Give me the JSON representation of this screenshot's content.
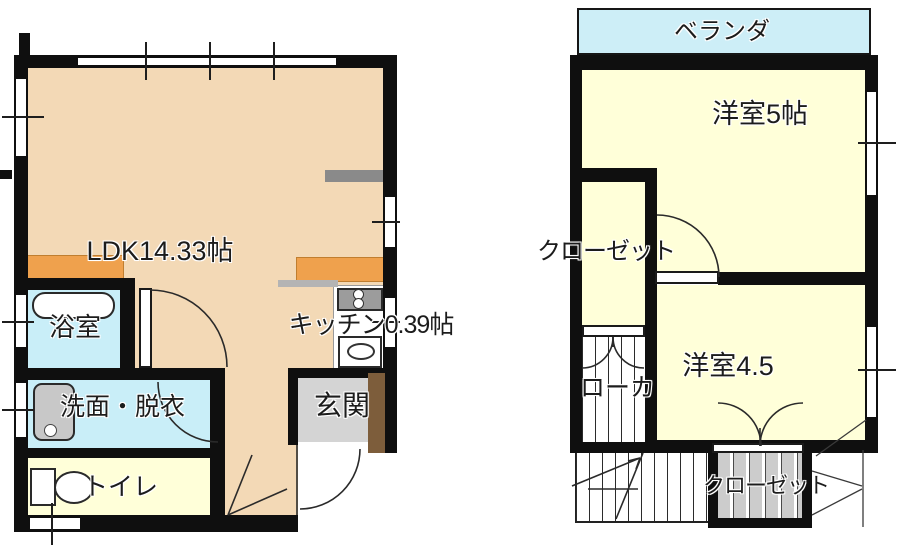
{
  "floor1": {
    "ldk": "LDK14.33帖",
    "bath": "浴室",
    "washroom": "洗面・脱衣",
    "toilet": "トイレ",
    "entrance": "玄関",
    "kitchen": "キッチン0.39帖"
  },
  "floor2": {
    "veranda": "ベランダ",
    "western_room_5": "洋室5帖",
    "closet_upper": "クローゼット",
    "hallway": "ローカ",
    "western_room_45": "洋室4.5",
    "closet_lower": "クローゼット"
  },
  "colors": {
    "wall": "#0f0f0f",
    "ldk_floor": "#f3d9b6",
    "wet_room_floor": "#c9eef8",
    "tatami_room_floor": "#ffffd9",
    "veranda_floor": "#cdeef7",
    "entrance_floor": "#d4d4d4",
    "counter_orange": "#efa14d",
    "entry_door_brown": "#7d5d3b",
    "closet_gray": "#cccccc"
  }
}
